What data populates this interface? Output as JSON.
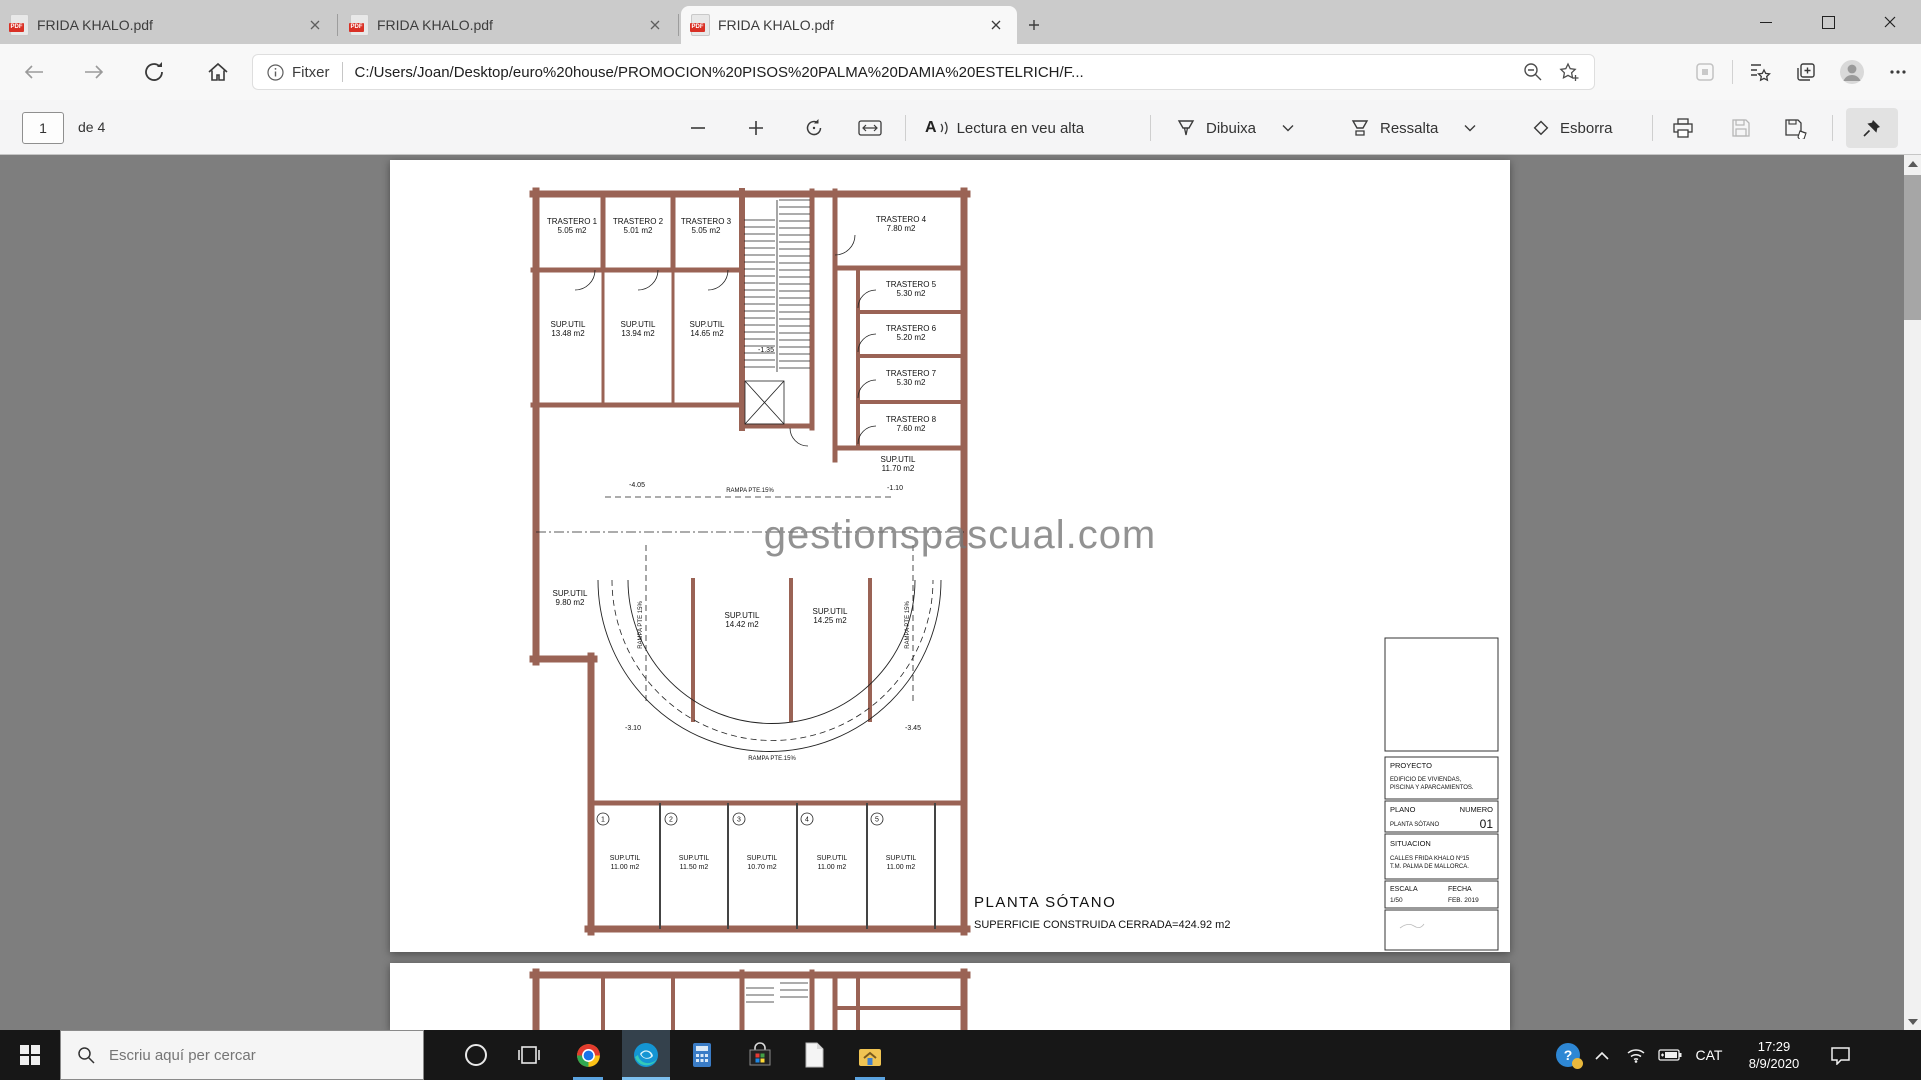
{
  "browser": {
    "tabs": [
      {
        "title": "FRIDA KHALO.pdf"
      },
      {
        "title": "FRIDA KHALO.pdf"
      },
      {
        "title": "FRIDA KHALO.pdf"
      }
    ],
    "pdf_badge": "PDF",
    "address": {
      "button_label": "Fitxer",
      "url": "C:/Users/Joan/Desktop/euro%20house/PROMOCION%20PISOS%20PALMA%20DAMIA%20ESTELRICH/F..."
    }
  },
  "pdf_toolbar": {
    "page_number": "1",
    "page_count": "de 4",
    "read_aloud": "Lectura en veu alta",
    "read_aloud_glyph": "A",
    "draw": "Dibuixa",
    "highlight": "Ressalta",
    "erase": "Esborra"
  },
  "plan": {
    "watermark": "gestionspascual.com",
    "title": "PLANTA  SÓTANO",
    "subtitle": "SUPERFICIE  CONSTRUIDA  CERRADA=424.92  m2",
    "rooms": [
      {
        "name": "TRASTERO 1",
        "area": "5.05 m2"
      },
      {
        "name": "TRASTERO 2",
        "area": "5.01 m2"
      },
      {
        "name": "TRASTERO 3",
        "area": "5.05 m2"
      },
      {
        "name": "TRASTERO 4",
        "area": "7.80 m2"
      },
      {
        "name": "TRASTERO 5",
        "area": "5.30 m2"
      },
      {
        "name": "TRASTERO 6",
        "area": "5.20 m2"
      },
      {
        "name": "TRASTERO 7",
        "area": "5.30 m2"
      },
      {
        "name": "TRASTERO 8",
        "area": "7.60 m2"
      },
      {
        "name": "SUP.UTIL",
        "area": "13.48 m2"
      },
      {
        "name": "SUP.UTIL",
        "area": "13.94 m2"
      },
      {
        "name": "SUP.UTIL",
        "area": "14.65 m2"
      },
      {
        "name": "SUP.UTIL",
        "area": "11.70 m2"
      },
      {
        "name": "SUP.UTIL",
        "area": "9.80 m2"
      },
      {
        "name": "SUP.UTIL",
        "area": "14.42 m2"
      },
      {
        "name": "SUP.UTIL",
        "area": "14.25 m2"
      }
    ],
    "levels": {
      "l1": "-1.35",
      "l2": "-4.05",
      "l3": "-1.10",
      "l4": "-3.10",
      "l5": "-3.45"
    },
    "ramp_label_top": "RAMPA PTE.15%",
    "ramp_label_bottom": "RAMPA PTE.15%",
    "ramp_label_left": "RAMPA PTE 15%",
    "ramp_label_right": "RAMPA PTE 15%",
    "parking": [
      {
        "num": "1",
        "line1": "SUP.UTIL",
        "line2": "11.00 m2"
      },
      {
        "num": "2",
        "line1": "SUP.UTIL",
        "line2": "11.50 m2"
      },
      {
        "num": "3",
        "line1": "SUP.UTIL",
        "line2": "10.70 m2"
      },
      {
        "num": "4",
        "line1": "SUP.UTIL",
        "line2": "11.00 m2"
      },
      {
        "num": "5",
        "line1": "SUP.UTIL",
        "line2": "11.00 m2"
      }
    ],
    "title_block": {
      "proyecto_label": "PROYECTO",
      "proyecto_line1": "EDIFICIO DE VIVIENDAS,",
      "proyecto_line2": "PISCINA Y APARCAMIENTOS.",
      "plano_label": "PLANO",
      "numero_label": "NUMERO",
      "plano_value": "PLANTA SÓTANO",
      "numero_value": "01",
      "situacion_label": "SITUACION",
      "situacion_line1": "CALLES FRIDA KHALO Nº15",
      "situacion_line2": "T.M. PALMA DE MALLORCA.",
      "escala_label": "ESCALA",
      "escala_value": "1/50",
      "fecha_label": "FECHA",
      "fecha_value": "FEB. 2019"
    }
  },
  "taskbar": {
    "search_placeholder": "Escriu aquí per cercar",
    "language": "CAT",
    "time": "17:29",
    "date": "8/9/2020",
    "help_glyph": "?"
  }
}
